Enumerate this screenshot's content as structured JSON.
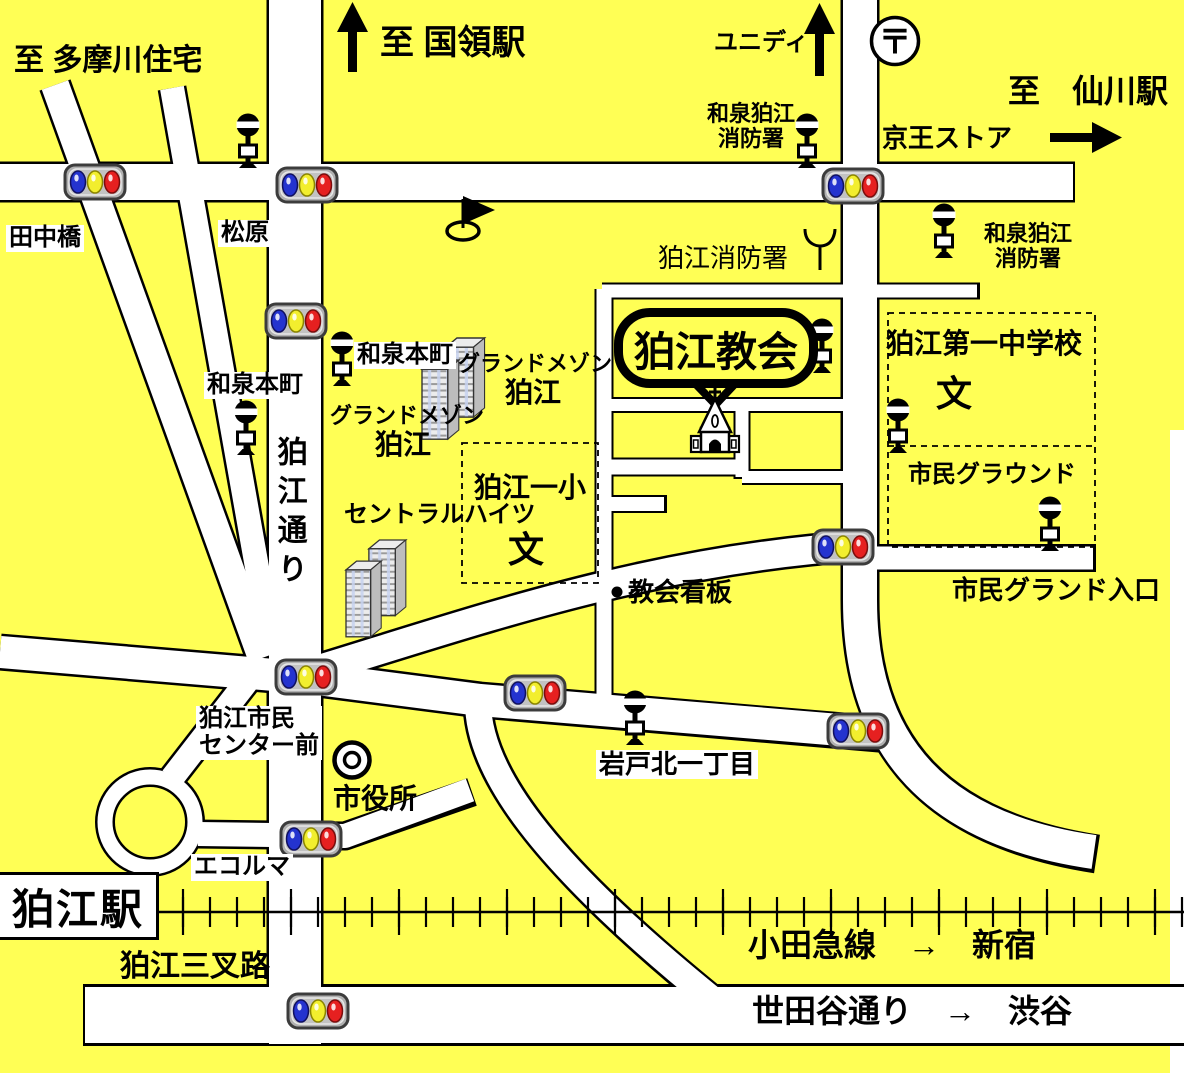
{
  "colors": {
    "background": "#ffff55",
    "road": "#ffffff",
    "outline": "#000000",
    "signal_body": "#b0b0b0",
    "signal_blue": "#2433cf",
    "signal_yellow": "#f2ee2e",
    "signal_red": "#e62020"
  },
  "labels": {
    "to_tamagawa": "至 多摩川住宅",
    "to_kokuryo": "至 国領駅",
    "unidy": "ユニディ",
    "post_mark": "〒",
    "to_sengawa": "至　仙川駅",
    "keio_store": "京王ストア",
    "izumi_komae_l1": "和泉狛江",
    "izumi_komae_l2": "消防署",
    "komae_fire": "狛江消防署",
    "tanaka_bridge": "田中橋",
    "matsubara": "松原",
    "izumi_honcho": "和泉本町",
    "komae_dori": "狛江通り",
    "grand_maison_l1": "グランドメゾン",
    "grand_maison_l2": "狛江",
    "central_heights": "セントラルハイツ",
    "komae_elementary": "狛江一小",
    "school_mark": "文",
    "komae_church": "狛江教会",
    "church_sign": "教会看板",
    "komae_first_jhs": "狛江第一中学校",
    "citizens_ground": "市民グラウンド",
    "citizens_ground_entrance": "市民グランド入口",
    "iwado_kita": "岩戸北一丁目",
    "civic_center_l1": "狛江市民",
    "civic_center_l2": "センター前",
    "city_hall": "市役所",
    "ecorma": "エコルマ",
    "komae_station": "狛江駅",
    "komae_sansaro": "狛江三叉路",
    "odakyu_line": "小田急線　→　新宿",
    "setagaya_dori": "世田谷通り　→　渋谷"
  },
  "icons": {
    "traffic_light": "traffic-light-icon (blue/yellow/red lamps)",
    "bus_stop": "bus-stop-icon",
    "church": "church-icon (chapel with cross)",
    "post_office": "post-office-icon (〒 in circle)",
    "city_hall": "double-circle-icon",
    "school": "文 mark",
    "flag": "flag-icon",
    "antenna": "antenna-icon",
    "building": "building-icon (twin towers)",
    "arrow_up": "↑",
    "arrow_right": "→",
    "church_sign_dot": "•"
  }
}
